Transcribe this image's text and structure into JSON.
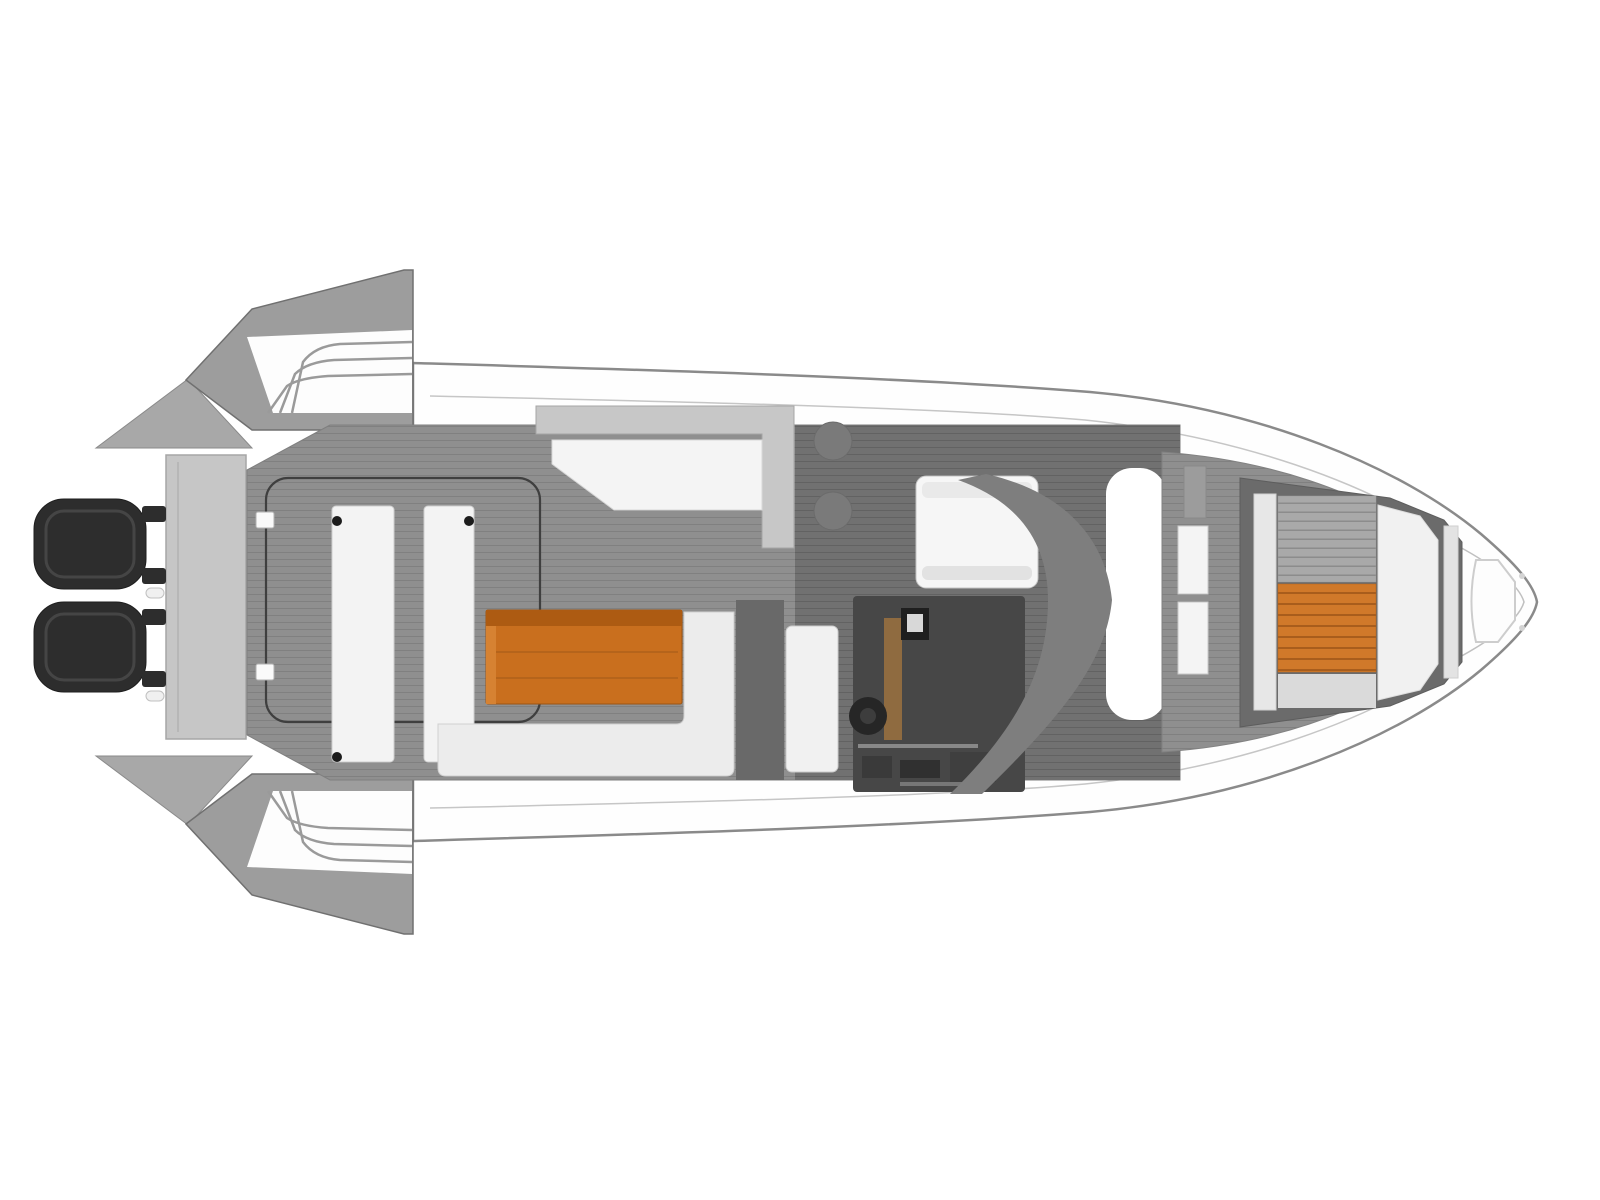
{
  "meta": {
    "title": "boat-deck-plan-top-view",
    "type": "floor-plan-diagram",
    "orientation": "bow-right"
  },
  "palette": {
    "background": "#ffffff",
    "hull_white": "#fefefe",
    "hull_outline": "#8a8a8a",
    "inner_gunwale_line": "#c6c6c6",
    "deck_gray": "#8f8f8f",
    "deck_dark": "#717171",
    "transom_gray": "#c6c6c6",
    "wing_gray": "#9d9d9d",
    "wing_stripe": "#9a9a9a",
    "seat_white": "#f3f3f3",
    "seat_outline": "#cfcfcf",
    "cockpit_line": "#3f3f3f",
    "table_teak": "#c96f1e",
    "table_teak_dark": "#ad5b12",
    "motor_black": "#2d2d2d",
    "console_dark": "#474747",
    "wheel_black": "#262626",
    "wood_brown": "#8f6b40",
    "windscreen_gray": "#7e7e7e",
    "stool_gray": "#7a7a7a",
    "sunpad_frame": "#6b6b6b",
    "sunpad_slat_gray": "#a9a9a9",
    "sunpad_teak": "#d0792a",
    "cushion_white": "#f1f1f1"
  },
  "components": {
    "hull": "white hull shell, bow pointing right",
    "outboard_motors": [
      "port outboard motor",
      "starboard outboard motor"
    ],
    "transom_platform": "light gray transom walkway behind motors",
    "stern_wings": [
      "fold-out terrace top",
      "fold-out terrace bottom"
    ],
    "aft_cockpit": [
      "aft bench seat left",
      "aft bench seat right",
      "teak cockpit table",
      "L-shaped sofa",
      "seat back panel"
    ],
    "wet_bar": [
      "L-shaped galley counter",
      "bar stool 1",
      "bar stool 2"
    ],
    "helm": [
      "helm seat",
      "helm console",
      "steering wheel",
      "console screen",
      "curved windscreen dashboard"
    ],
    "walkway": "white side passage between helm and bow lounge",
    "bow_area": [
      "step cushions",
      "gray slatted sunpad",
      "teak sunpad insert",
      "white bow cushion",
      "bow backrest panel",
      "anchor locker outline"
    ]
  }
}
